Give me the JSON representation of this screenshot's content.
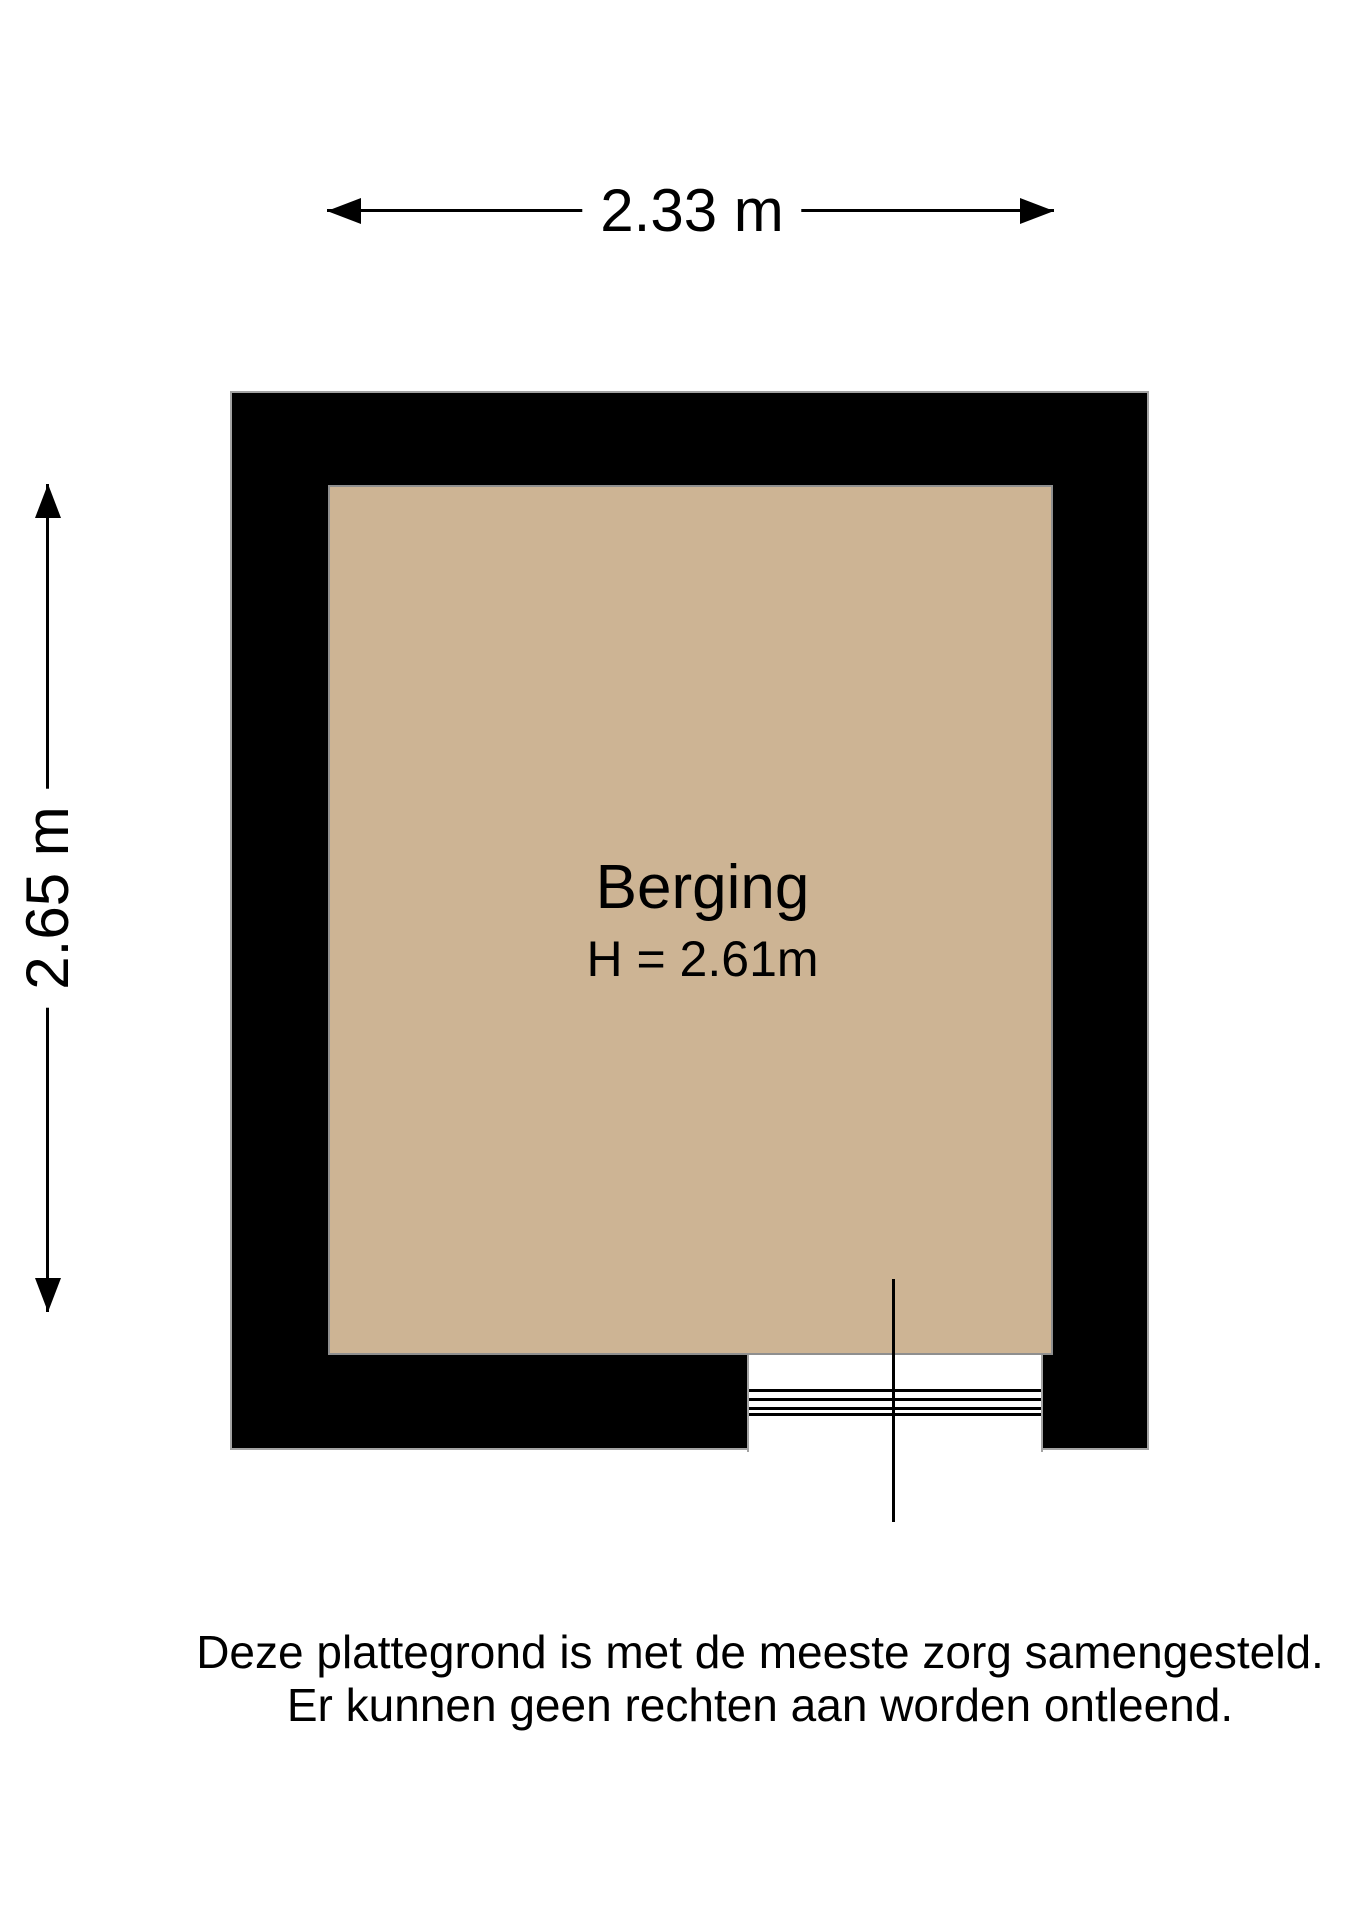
{
  "room": {
    "name": "Berging",
    "height_label": "H = 2.61m"
  },
  "dimensions": {
    "width_label": "2.33 m",
    "height_label": "2.65 m"
  },
  "disclaimer": {
    "line1": "Deze plattegrond is met de meeste zorg samengesteld.",
    "line2": "Er kunnen geen rechten aan worden ontleend."
  },
  "colors": {
    "floor": "#cdb494",
    "wall": "#000000",
    "line": "#000000",
    "stroke": "#a3a3a3",
    "background": "#ffffff"
  }
}
